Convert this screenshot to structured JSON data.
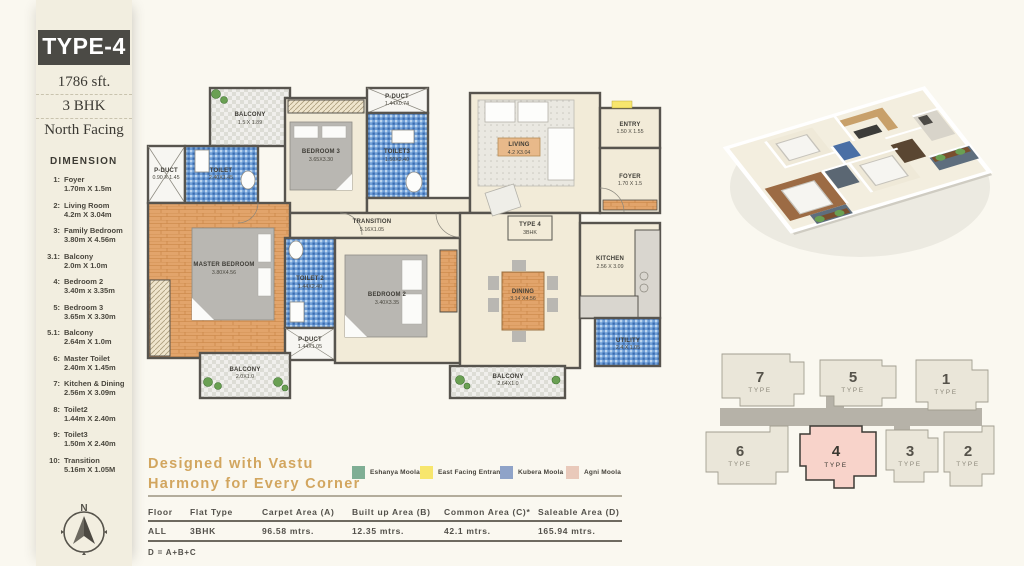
{
  "sidebar": {
    "type_badge": "TYPE-4",
    "area": "1786 sft.",
    "bhk": "3 BHK",
    "facing": "North Facing",
    "dimension_heading": "DIMENSION",
    "items": [
      {
        "num": "1:",
        "name": "Foyer",
        "size": "1.70m X 1.5m"
      },
      {
        "num": "2:",
        "name": "Living Room",
        "size": "4.2m X 3.04m"
      },
      {
        "num": "3:",
        "name": "Family Bedroom",
        "size": "3.80m X 4.56m"
      },
      {
        "num": "3.1:",
        "name": "Balcony",
        "size": "2.0m X 1.0m"
      },
      {
        "num": "4:",
        "name": "Bedroom 2",
        "size": "3.40m x 3.35m"
      },
      {
        "num": "5:",
        "name": "Bedroom 3",
        "size": "3.65m X 3.30m"
      },
      {
        "num": "5.1:",
        "name": "Balcony",
        "size": "2.64m X 1.0m"
      },
      {
        "num": "6:",
        "name": "Master Toilet",
        "size": "2.40m X 1.45m"
      },
      {
        "num": "7:",
        "name": "Kitchen & Dining",
        "size": "2.56m X 3.09m"
      },
      {
        "num": "8:",
        "name": "Toilet2",
        "size": "1.44m X 2.40m"
      },
      {
        "num": "9:",
        "name": "Toilet3",
        "size": "1.50m X 2.40m"
      },
      {
        "num": "10:",
        "name": "Transition",
        "size": "5.16m X 1.05M"
      }
    ],
    "compass": {
      "label": "N"
    }
  },
  "floor_plan": {
    "rooms": {
      "balcony_top": {
        "name": "BALCONY",
        "size": "1.5 X 1.89"
      },
      "pduct_left": {
        "name": "P-DUCT",
        "size": "0.90 X 1.45"
      },
      "toilet_master": {
        "name": "TOILET",
        "size": "2.40X1.45"
      },
      "bedroom3": {
        "name": "BEDROOM 3",
        "size": "3.65X3.30"
      },
      "pduct_top": {
        "name": "P-DUCT",
        "size": "1.44X0.74"
      },
      "toilet3": {
        "name": "TOILET3",
        "size": "1.50X2.40"
      },
      "living": {
        "name": "LIVING",
        "size": "4.2 X3.04"
      },
      "entry": {
        "name": "ENTRY",
        "size": "1.50 X 1.55"
      },
      "foyer": {
        "name": "FOYER",
        "size": "1.70 X 1.5"
      },
      "transition": {
        "name": "TRANSITION",
        "size": "5.16X1.05"
      },
      "master": {
        "name": "MASTER BEDROOM",
        "size": "3.80X4.56"
      },
      "toilet2": {
        "name": "TOILET 2",
        "size": "1.44X2.40"
      },
      "pduct_mid": {
        "name": "P-DUCT",
        "size": "1.44X1.05"
      },
      "bedroom2": {
        "name": "BEDROOM 2",
        "size": "3.40X3.35"
      },
      "dining": {
        "name": "DINING",
        "size": "3.14 X4.56"
      },
      "kitchen": {
        "name": "KITCHEN",
        "size": "2.56 X 3.09"
      },
      "utility": {
        "name": "UTILITY",
        "size": "2.4 X 1.05"
      },
      "balcony_bl": {
        "name": "BALCONY",
        "size": "2.0X1.0"
      },
      "balcony_bc": {
        "name": "BALCONY",
        "size": "2.64X1.0"
      }
    },
    "type_box": {
      "line1": "TYPE 4",
      "line2": "3BHK"
    }
  },
  "vastu": {
    "tagline_line1": "Designed with Vastu",
    "tagline_line2": "Harmony for Every Corner",
    "legend": [
      {
        "label": "Eshanya Moola",
        "color": "#7fae94"
      },
      {
        "label": "East Facing Entrance",
        "color": "#f7e66d"
      },
      {
        "label": "Kubera Moola",
        "color": "#8fa3c8"
      },
      {
        "label": "Agni Moola",
        "color": "#e9c9ba"
      }
    ]
  },
  "key_plan": {
    "highlight_color": "#f8d3ca",
    "units": [
      {
        "num": "7",
        "label": "TYPE"
      },
      {
        "num": "5",
        "label": "TYPE"
      },
      {
        "num": "1",
        "label": "TYPE"
      },
      {
        "num": "6",
        "label": "TYPE"
      },
      {
        "num": "4",
        "label": "TYPE"
      },
      {
        "num": "3",
        "label": "TYPE"
      },
      {
        "num": "2",
        "label": "TYPE"
      }
    ]
  },
  "area_table": {
    "headers": [
      "Floor",
      "Flat Type",
      "Carpet Area (A)",
      "Built up Area (B)",
      "Common Area (C)*",
      "Saleable Area (D)"
    ],
    "row": [
      "ALL",
      "3BHK",
      "96.58 mtrs.",
      "12.35 mtrs.",
      "42.1 mtrs.",
      "165.94 mtrs."
    ],
    "footnote": "D = A+B+C"
  }
}
